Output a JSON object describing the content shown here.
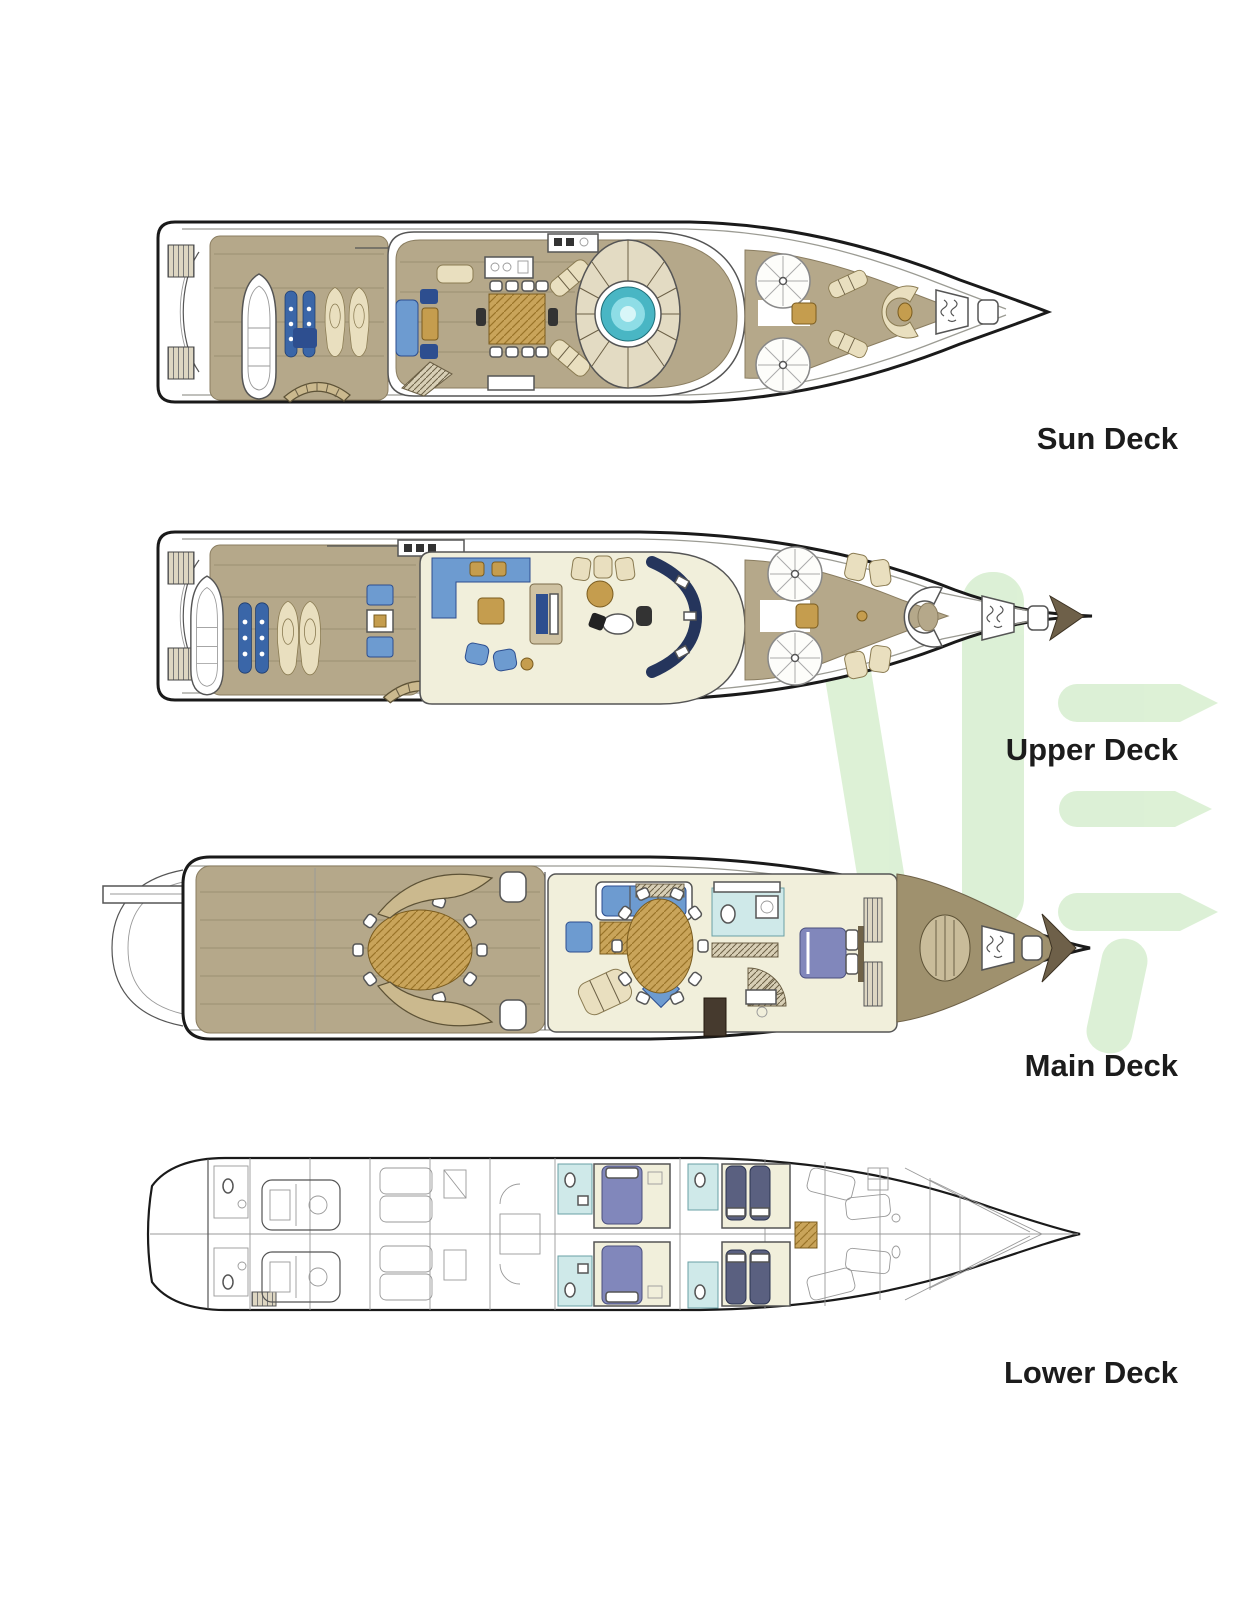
{
  "decks": [
    {
      "id": "sun-deck",
      "label": "Sun Deck"
    },
    {
      "id": "upper-deck",
      "label": "Upper Deck"
    },
    {
      "id": "main-deck",
      "label": "Main Deck"
    },
    {
      "id": "lower-deck",
      "label": "Lower Deck"
    }
  ],
  "watermark": {
    "description": "light-green logo letters behind plans",
    "color": "#d9efd2"
  },
  "palette": {
    "outline": "#1a1a1a",
    "label": "#1c1c1c",
    "teak": "#b5a88a",
    "teak_dark": "#9f916e",
    "floor": "#f1efdb",
    "wood": "#c59d4e",
    "blue": "#6d9bd0",
    "navy": "#2d4e8f",
    "beige": "#e9dfbf",
    "bath": "#cfe9e9",
    "bed_purple": "#8187bb",
    "bed_navy": "#5a6080",
    "pool": "#49b6c4",
    "pool_light": "#8edde6",
    "watermark": "#d9efd2"
  }
}
